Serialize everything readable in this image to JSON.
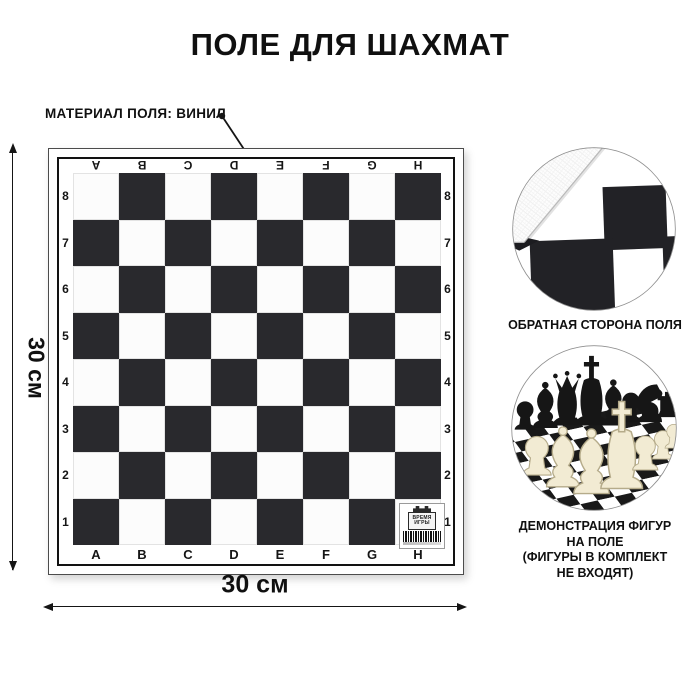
{
  "title": "ПОЛЕ ДЛЯ ШАХМАТ",
  "annotation": {
    "label": "МАТЕРИАЛ ПОЛЯ: ВИНИЛ"
  },
  "dimensions": {
    "width_label": "30 см",
    "height_label": "30 см"
  },
  "board": {
    "files": [
      "A",
      "B",
      "C",
      "D",
      "E",
      "F",
      "G",
      "H"
    ],
    "ranks": [
      "8",
      "7",
      "6",
      "5",
      "4",
      "3",
      "2",
      "1"
    ],
    "colors": {
      "dark_square": "#29292d",
      "light_square": "#fcfcfc",
      "frame": "#121212"
    },
    "badge": {
      "brand_top": "ВРЕМЯ",
      "brand_bottom": "ИГРЫ"
    }
  },
  "insets": {
    "back_side": {
      "caption": "ОБРАТНАЯ СТОРОНА ПОЛЯ"
    },
    "pieces_demo": {
      "caption_lines": [
        "ДЕМОНСТРАЦИЯ ФИГУР",
        "НА ПОЛЕ",
        "(ФИГУРЫ В КОМПЛЕКТ",
        "НЕ ВХОДЯТ)"
      ]
    }
  }
}
